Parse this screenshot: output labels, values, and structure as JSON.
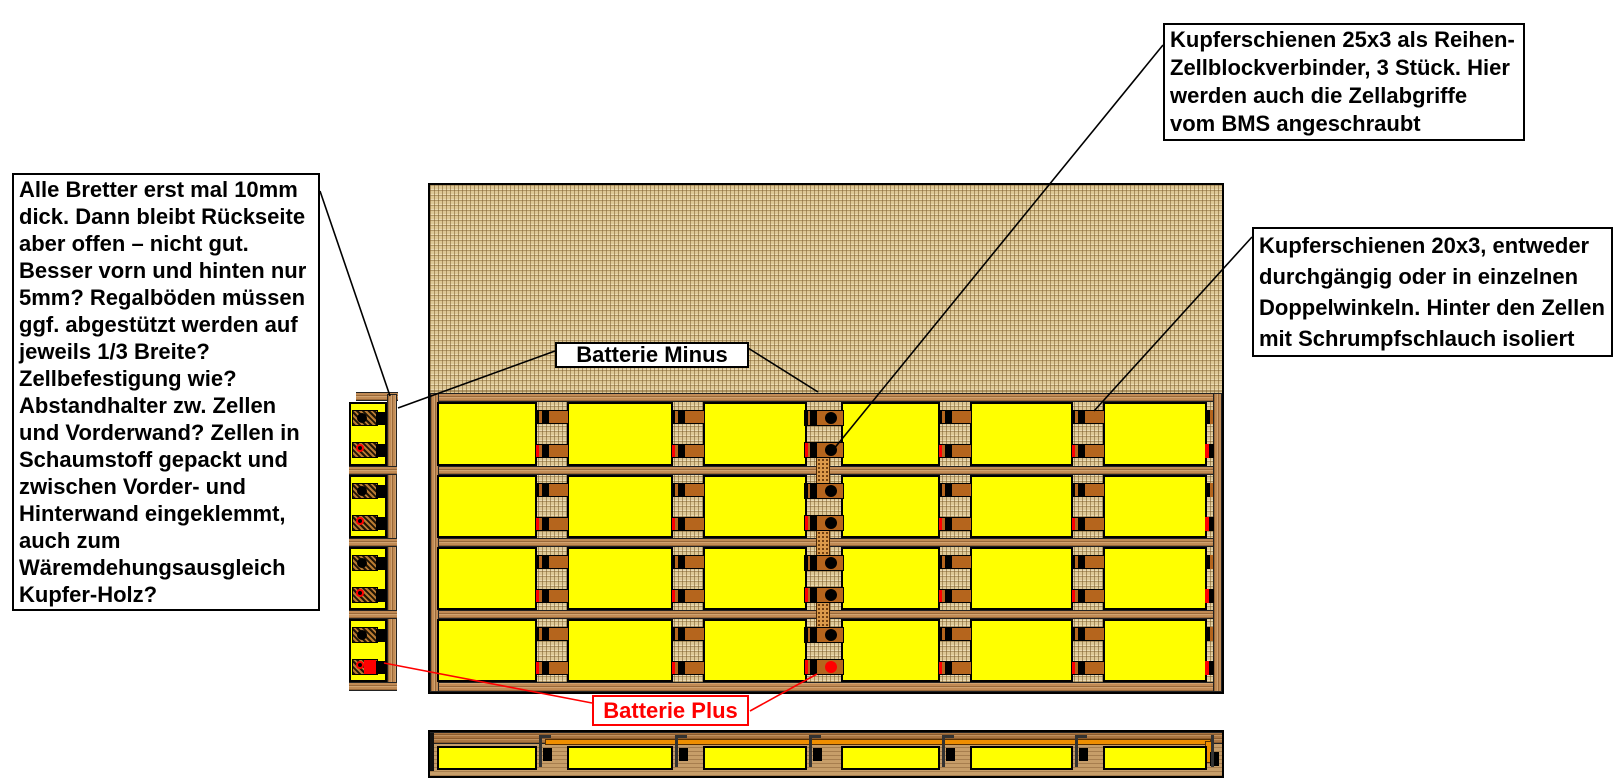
{
  "annotations": {
    "left_note": "Alle Bretter erst mal 10mm dick. Dann bleibt Rückseite aber offen – nicht gut. Besser vorn und hinten nur 5mm? Regalböden müssen ggf. abgestützt werden auf jeweils 1/3 Breite? Zellbefestigung wie? Abstandhalter zw. Zellen und Vorderwand? Zellen in Schaumstoff gepackt und zwischen Vorder- und Hinterwand eingeklemmt, auch zum Wäremdehungsausgleich Kupfer-Holz?",
    "busbar_25x3_note": "Kupferschienen 25x3 als Reihen-Zellblockverbinder, 3 Stück. Hier werden auch die Zellabgriffe vom BMS angeschraubt",
    "busbar_20x3_note": "Kupferschienen 20x3, entweder durchgängig oder in einzelnen Doppelwinkeln. Hinter den Zellen mit Schrumpfschlauch isoliert",
    "battery_minus_label": "Batterie Minus",
    "battery_plus_label": "Batterie Plus"
  },
  "structure": {
    "rows": 4,
    "cells_per_row_front_view": 6,
    "cells_side_view": 4,
    "cells_bottom_view": 6,
    "connector_columns": 5,
    "series_connector_columns": 1
  },
  "colors": {
    "cell_yellow": "#ffff00",
    "copper": "#b5651d",
    "copper_stipple": "#dc9a4a",
    "busbar_orange": "#ef8e00",
    "plus_red": "#ff0000",
    "burlap_board": "#dec896",
    "shelf_wood": "#c18b55",
    "note_text": "#000000"
  }
}
